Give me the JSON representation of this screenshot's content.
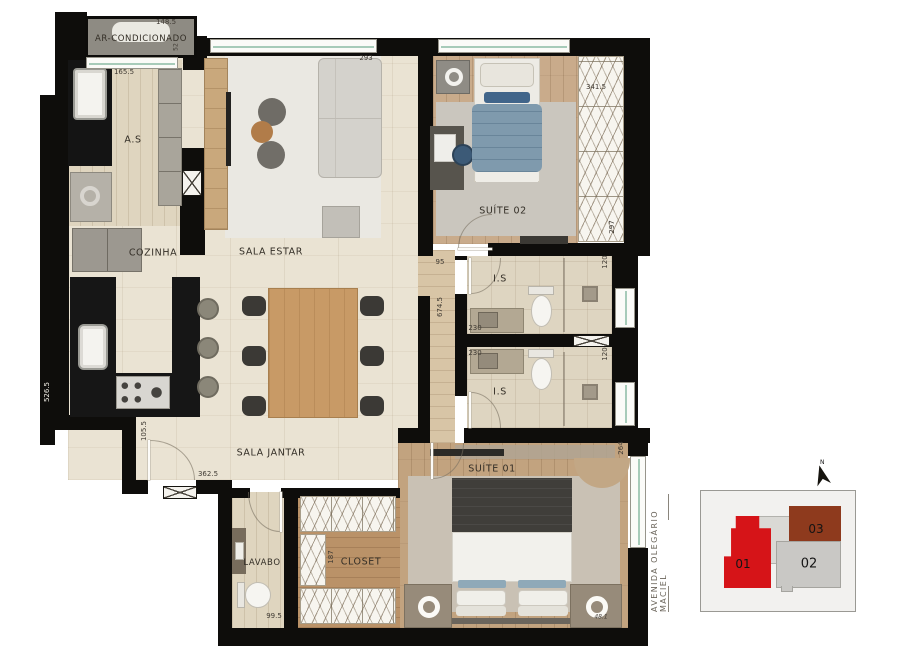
{
  "rooms": {
    "ar": "AR-CONDICIONADO",
    "as": "A.S",
    "cozinha": "COZINHA",
    "sala_estar": "SALA ESTAR",
    "sala_jantar": "SALA JANTAR",
    "suite02": "SUÍTE 02",
    "suite01": "SUÍTE 01",
    "is_upper": "I.S",
    "is_lower": "I.S",
    "lavabo": "LAVABO",
    "closet": "CLOSET"
  },
  "measurements": {
    "ac_width": "148.5",
    "ac_side": "52",
    "as_window": "165.5",
    "sala_window": "293",
    "suite02_window": "341.5",
    "suite02_depth": "297",
    "hall_width": "95",
    "hall_length": "674.5",
    "is_upper_width": "230",
    "is_upper_depth": "120",
    "is_lower_width": "230",
    "is_lower_depth": "120",
    "suite01_window": "264",
    "suite01_corner": "48.1",
    "kitchen_wall": "526.5",
    "entry_wall": "105.5",
    "jantar_wall": "362.5",
    "lavabo_width": "99.5",
    "closet_depth": "187"
  },
  "street_label": "AVENIDA OLEGÁRIO MACIEL",
  "keyplan": {
    "north_label": "N",
    "units": [
      {
        "id": "01",
        "color": "#d61418"
      },
      {
        "id": "02",
        "color": "#c9c8c5"
      },
      {
        "id": "03",
        "color": "#8e3a1d"
      }
    ]
  },
  "palette": {
    "wall": "#0e0d0b",
    "floor_tile": "#eae3d3",
    "floor_wood": "#c9ab8b",
    "rug": "#cac6be",
    "counter": "#161616",
    "window_glass": "#a7cbb9",
    "bed_blue": "#7f9aad"
  }
}
